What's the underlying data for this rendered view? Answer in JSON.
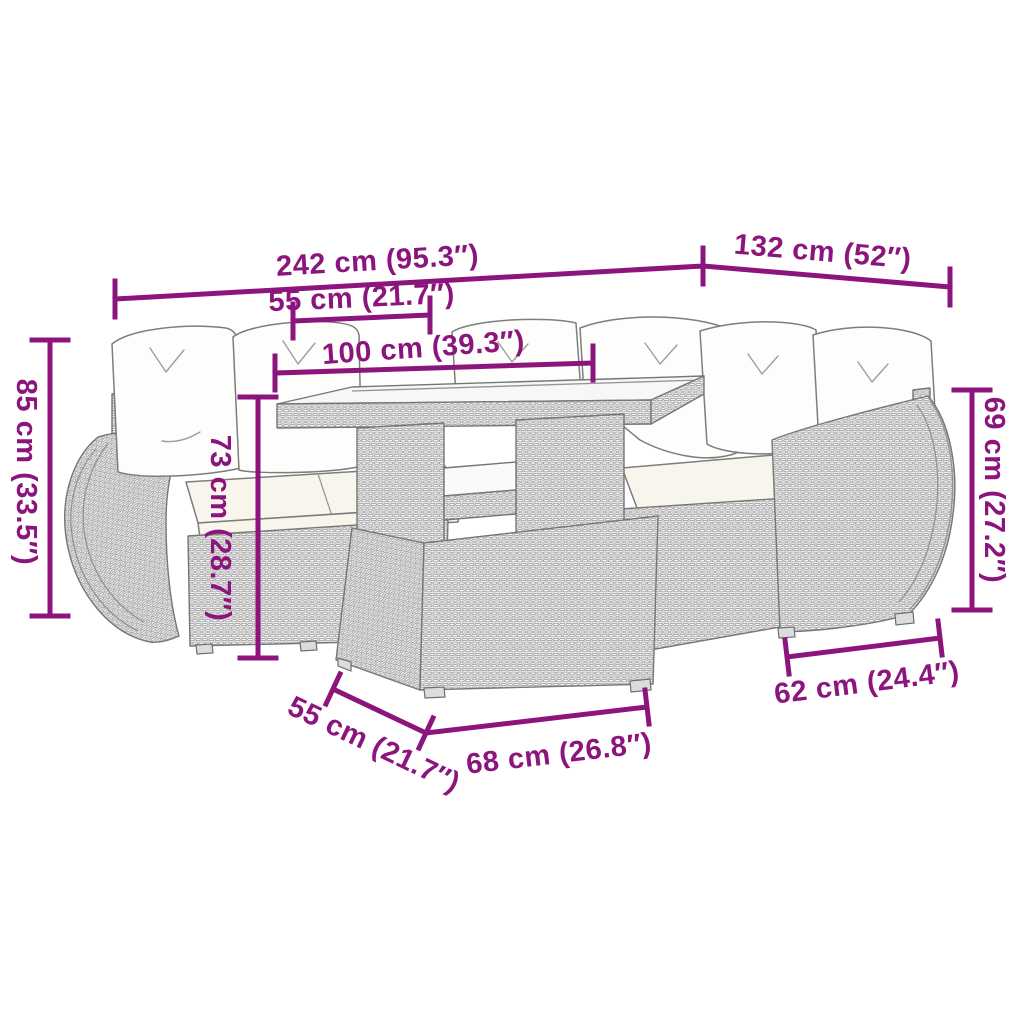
{
  "colors": {
    "accent": "#8c147d",
    "line_art": "#8a8a8a",
    "cushion_fill": "#fdfdfb",
    "background": "#ffffff"
  },
  "dimensions": [
    {
      "id": "overall-width",
      "label": "242 cm (95.3″)",
      "orientation": "horizontal"
    },
    {
      "id": "right-side-width",
      "label": "132 cm (52″)",
      "orientation": "horizontal"
    },
    {
      "id": "seat-depth",
      "label": "55 cm (21.7″)",
      "orientation": "horizontal"
    },
    {
      "id": "table-width",
      "label": "100 cm (39.3″)",
      "orientation": "horizontal"
    },
    {
      "id": "back-height",
      "label": "85 cm (33.5″)",
      "orientation": "vertical"
    },
    {
      "id": "table-height",
      "label": "73 cm (28.7″)",
      "orientation": "vertical"
    },
    {
      "id": "arm-height",
      "label": "69 cm (27.2″)",
      "orientation": "vertical"
    },
    {
      "id": "module-width",
      "label": "62 cm (24.4″)",
      "orientation": "horizontal"
    },
    {
      "id": "ottoman-depth",
      "label": "55 cm (21.7″)",
      "orientation": "diagonal"
    },
    {
      "id": "ottoman-width",
      "label": "68 cm (26.8″)",
      "orientation": "horizontal"
    }
  ]
}
